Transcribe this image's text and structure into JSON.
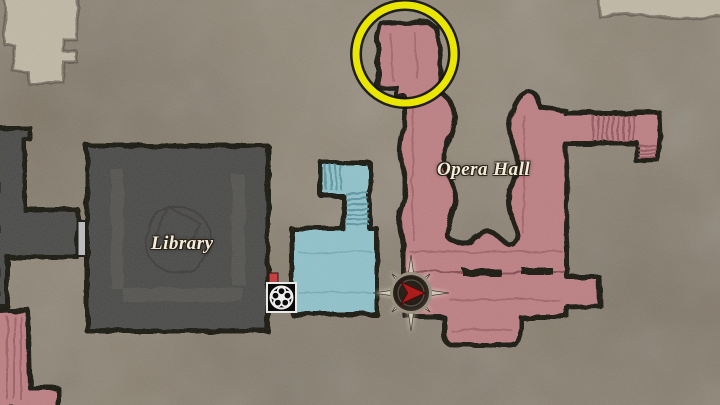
{
  "map": {
    "labels": {
      "library": "Library",
      "opera_hall": "Opera Hall"
    },
    "colors": {
      "background": "#8b8171",
      "unexplored_light": "#c1b8a6",
      "room_dark": "#4a4846",
      "room_blue": "#8fc2cb",
      "room_red": "#bd7f83",
      "ink_border": "#17120e",
      "highlight_yellow": "#ebe600",
      "door_marker_gray": "#bcbcbc",
      "item_marker_red": "#c64242",
      "player_arrow_red": "#ab1d1d",
      "compass_ring_gray": "#9a9181"
    },
    "markers": {
      "highlight_circle": "objective-highlight",
      "player": "player-position-facing-east",
      "mechanism_icon": "black-box-reel-emblem",
      "item_marker": "red-square-marker",
      "door_marker": "gray-door-bar"
    }
  }
}
